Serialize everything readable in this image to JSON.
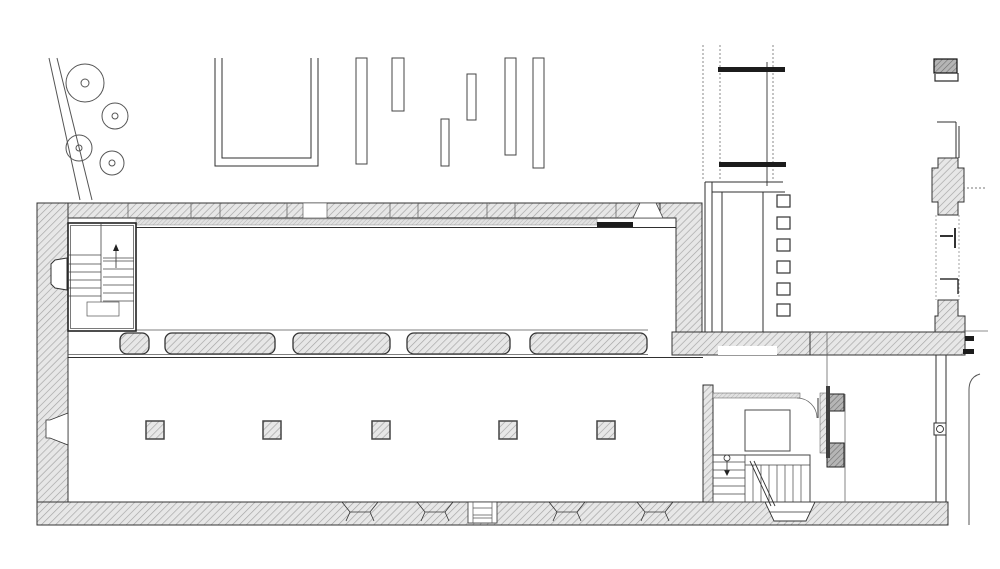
{
  "meta": {
    "drawing_type": "architectural-floor-plan",
    "canvas": {
      "width": 1000,
      "height": 569
    },
    "visible_text": []
  },
  "colors": {
    "background": "#ffffff",
    "line_dark": "#2f2f2f",
    "line_mid": "#555555",
    "line_light": "#8a8a8a",
    "wall_fill": "#e7e7e7",
    "wall_hatch": "#a3a3a3",
    "sill_fill": "#e2e2e2",
    "sill_hatch": "#b4b4b4",
    "dark_fill": "#1c1c1c",
    "dark_pier_fill": "#b5b5b5",
    "dark_pier_hatch": "#6e6e6e"
  },
  "site": {
    "path_lines": [
      [
        49,
        58,
        80,
        200
      ],
      [
        57,
        58,
        92,
        200
      ]
    ],
    "trees": [
      {
        "cx": 85,
        "cy": 83,
        "r": 19,
        "core": 4
      },
      {
        "cx": 115,
        "cy": 116,
        "r": 13,
        "core": 3
      },
      {
        "cx": 79,
        "cy": 148,
        "r": 13,
        "core": 3
      },
      {
        "cx": 112,
        "cy": 163,
        "r": 12,
        "core": 3
      }
    ],
    "planter": {
      "outer": [
        215,
        58,
        318,
        166
      ],
      "inner": [
        222,
        58,
        311,
        158
      ]
    },
    "wall_fragments": [
      [
        356,
        58,
        11,
        106
      ],
      [
        392,
        58,
        12,
        53
      ],
      [
        441,
        119,
        8,
        47
      ],
      [
        467,
        74,
        9,
        46
      ],
      [
        505,
        58,
        11,
        97
      ],
      [
        533,
        58,
        11,
        110
      ]
    ],
    "canopy": {
      "dashed_x": [
        703,
        720,
        773
      ],
      "dash_y1": 45,
      "dash_y2": 181,
      "post_line": [
        767,
        62,
        767,
        186
      ],
      "bars": [
        [
          718,
          67,
          67,
          5
        ],
        [
          719,
          162,
          67,
          5
        ]
      ]
    }
  },
  "building": {
    "top_band_joints": [
      128,
      191,
      220,
      287,
      390,
      418,
      487,
      515,
      616
    ],
    "top_opening_rect": [
      303,
      203,
      24,
      15
    ],
    "top_opening_trapezoid": "640,203 656,203 663,218 633,218",
    "hall_piers": {
      "y": 333,
      "h": 21,
      "rx": 7,
      "segments": [
        [
          120,
          29
        ],
        [
          165,
          110
        ],
        [
          293,
          97
        ],
        [
          407,
          103
        ],
        [
          530,
          117
        ]
      ]
    },
    "corridor_squares": {
      "x": 777,
      "w": 13,
      "h": 12,
      "ys": [
        195,
        217,
        239,
        261,
        283,
        304
      ]
    },
    "columns": {
      "xs": [
        146,
        263,
        372,
        499,
        597
      ],
      "y": 421,
      "size": 18
    },
    "bottom_window_centers": [
      360,
      435,
      567,
      655
    ],
    "bottom_door": {
      "x": 468,
      "y": 502,
      "w": 29,
      "h": 21,
      "jambs": [
        473,
        492
      ],
      "sills": [
        508,
        515,
        518
      ]
    },
    "stairwell_main": {
      "x": 68,
      "y": 223,
      "w": 68,
      "h": 108,
      "divider_x": 101,
      "landing_y": 255,
      "left_treads_y": [
        264,
        272,
        280,
        288,
        296
      ],
      "right_x": 103,
      "right_w": 31,
      "right_top_y": [
        258,
        261
      ],
      "right_treads_y": [
        269,
        277,
        285,
        293,
        301
      ],
      "route_rect": [
        87,
        302,
        32,
        14
      ]
    },
    "stair_room": {
      "box": [
        713,
        455,
        97,
        47
      ],
      "left_treads_y": [
        462,
        470,
        478,
        486,
        494
      ],
      "divider_x": 745,
      "tread_xs": [
        753,
        761,
        769,
        777,
        785,
        793,
        801
      ],
      "tread_y1": 465,
      "tread_y2": 502,
      "table": [
        745,
        410,
        45,
        41
      ]
    }
  }
}
